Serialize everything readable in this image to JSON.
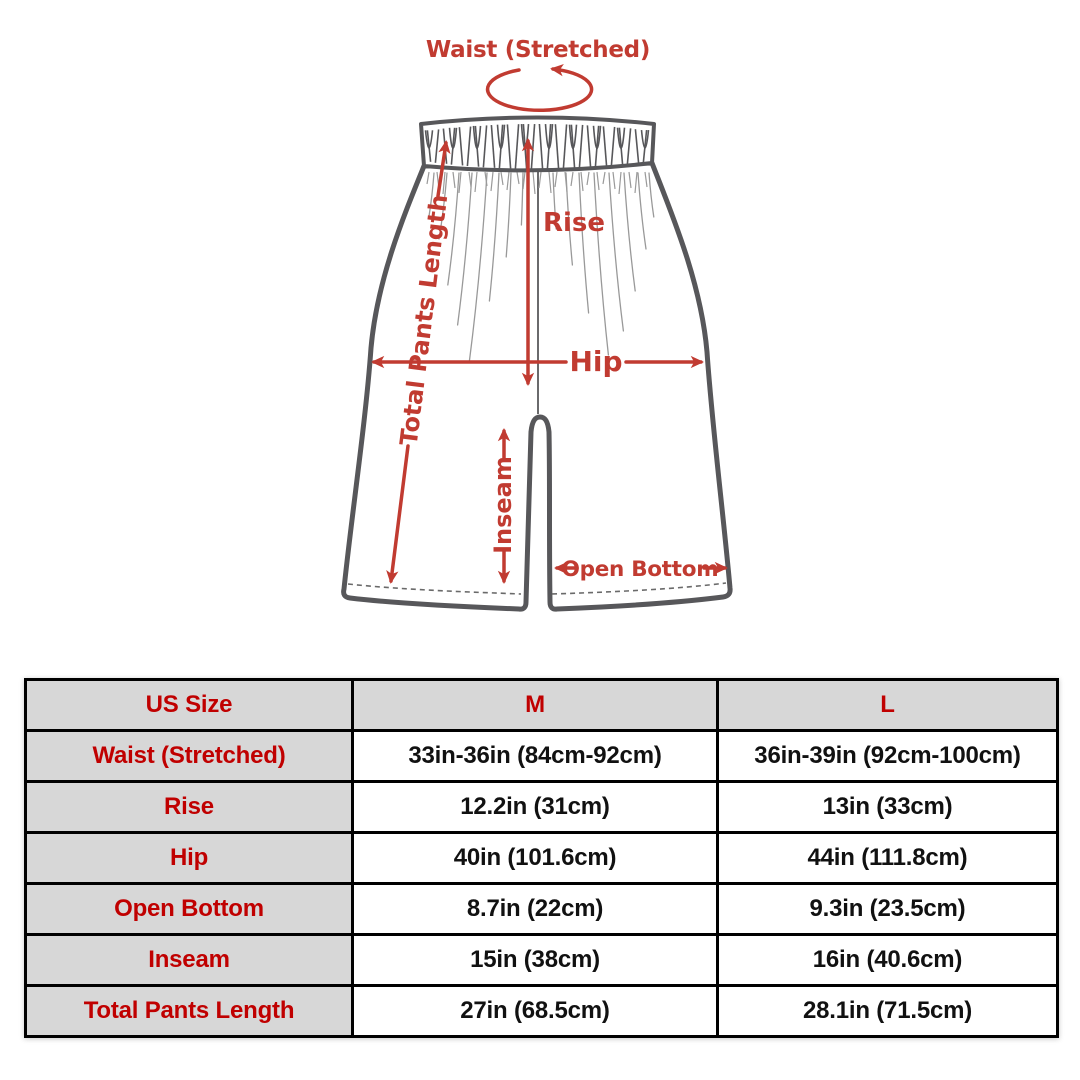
{
  "page": {
    "background": "#ffffff"
  },
  "diagram": {
    "title": "Waist (Stretched)",
    "labels": {
      "rise": "Rise",
      "hip": "Hip",
      "total_pants_length": "Total Pants Length",
      "inseam": "Inseam",
      "open_bottom": "Open Bottom"
    },
    "colors": {
      "annotation_red": "#c13b31",
      "outline_gray": "#57575a"
    }
  },
  "size_table": {
    "columns": [
      "US Size",
      "M",
      "L"
    ],
    "rows": [
      {
        "label": "Waist (Stretched)",
        "m": "33in-36in (84cm-92cm)",
        "l": "36in-39in (92cm-100cm)"
      },
      {
        "label": "Rise",
        "m": "12.2in (31cm)",
        "l": "13in (33cm)"
      },
      {
        "label": "Hip",
        "m": "40in (101.6cm)",
        "l": "44in (111.8cm)"
      },
      {
        "label": "Open Bottom",
        "m": "8.7in (22cm)",
        "l": "9.3in (23.5cm)"
      },
      {
        "label": "Inseam",
        "m": "15in (38cm)",
        "l": "16in (40.6cm)"
      },
      {
        "label": "Total Pants Length",
        "m": "27in (68.5cm)",
        "l": "28.1in (71.5cm)"
      }
    ],
    "colors": {
      "header_bg": "#d7d7d7",
      "label_red": "#c00000",
      "value_black": "#111111"
    }
  }
}
